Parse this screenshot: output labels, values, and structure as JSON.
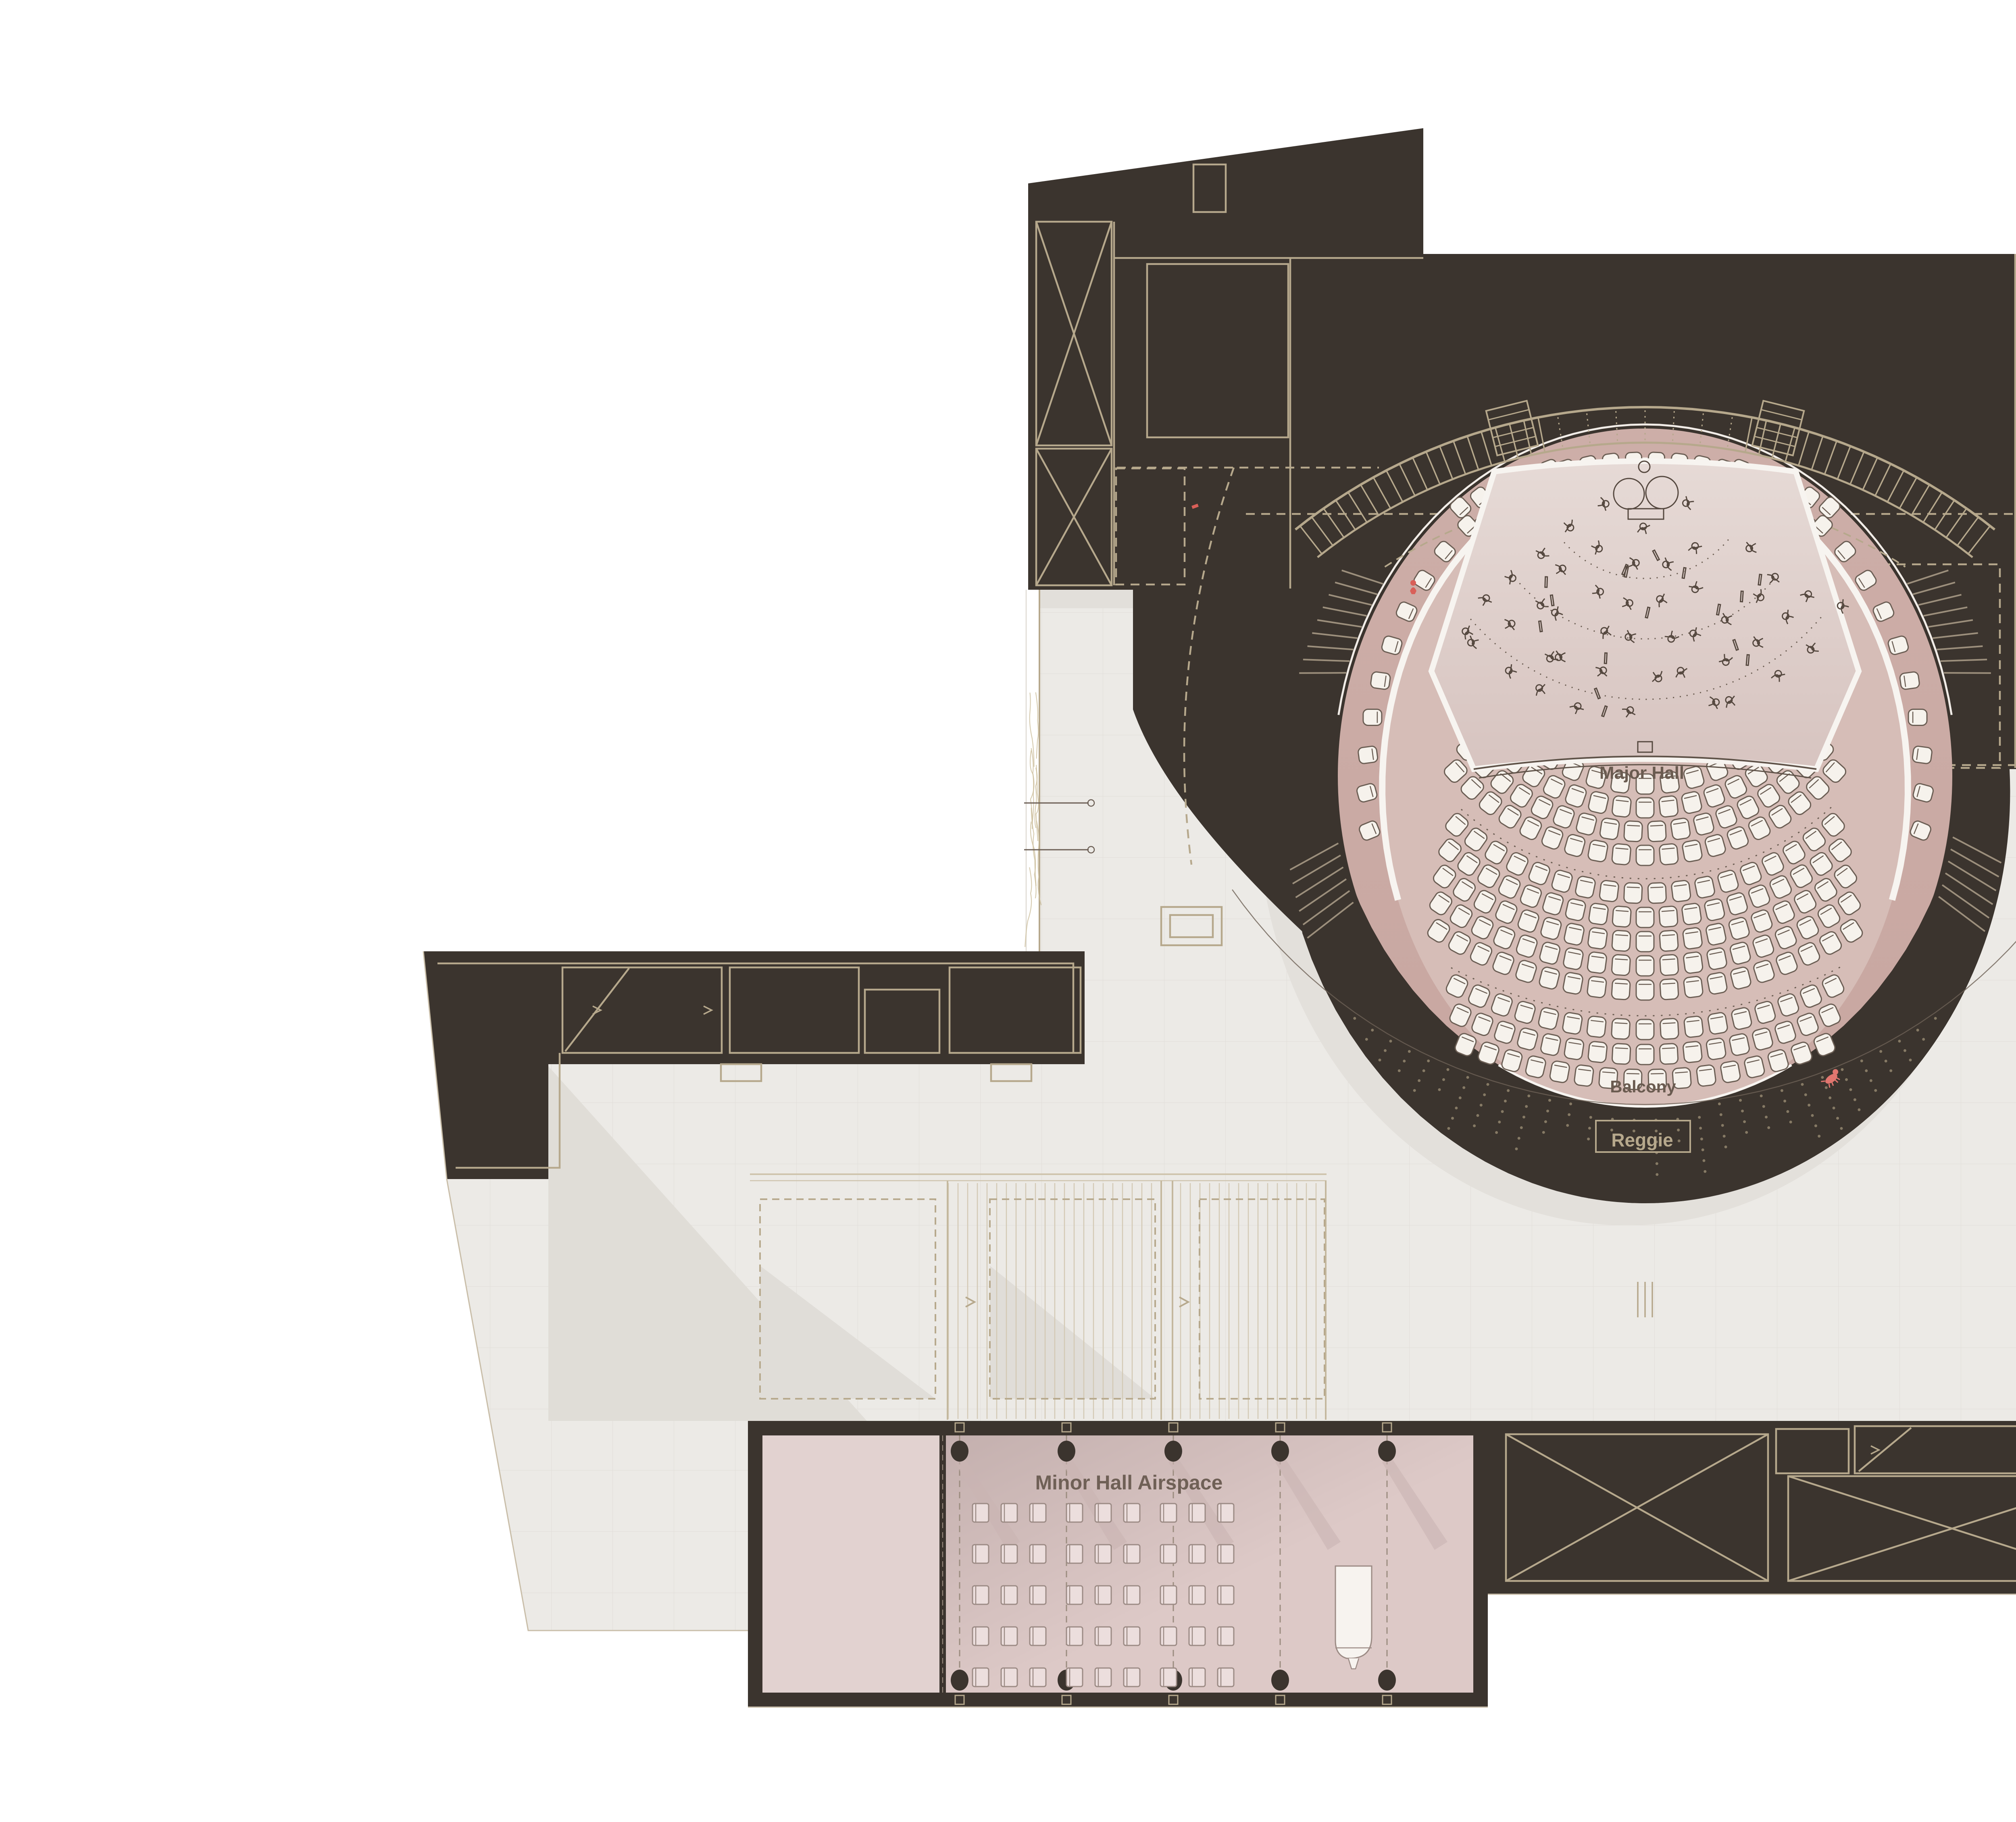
{
  "plan": {
    "type": "architectural floor plan",
    "halls": [
      "Major Hall",
      "Minor Hall"
    ]
  },
  "labels": {
    "major_hall": "Major Hall",
    "balcony": "Balcony",
    "reggie": "Reggie",
    "minor_hall_airspace": "Minor Hall Airspace"
  },
  "colors": {
    "background": "#ffffff",
    "dark_mass": "#3b342e",
    "dark_mass_edge": "#2f2a24",
    "line_tan": "#b6a88c",
    "line_tan_soft": "#cfc4ad",
    "floor": "#eceae6",
    "floor_line": "#e1ded9",
    "shadow": "#dfdcd6",
    "hall_band_pink": "#cdaea8",
    "hall_inner_pink": "#d6bdb7",
    "stage_light_top": "#e6dad6",
    "stage_light_bottom": "#d7c4c0",
    "minor_pink": "#ddc9c7",
    "minor_vestibule": "#e2d2d0",
    "seat_fill": "#f6f2ec",
    "seat_stroke": "#6b5e54",
    "ink": "#55483f",
    "label_ink": "#6a5b50",
    "minor_label_ink": "#6f6056",
    "white_band": "#f7f4f0",
    "vine": "#cdbf9e",
    "red_accent": "#d95f58",
    "dog_pink": "#e2766f",
    "bowl_dot": "#94876f"
  },
  "seating": {
    "organ_gallery_rows": 2,
    "choir_files": 2,
    "stalls_front_rows": 4,
    "stalls_rear_rows": 5,
    "balcony_rows": 3,
    "minor_hall_seat_grid": {
      "cols": 9,
      "rows": 5
    }
  },
  "icons": [
    {
      "name": "timpani-icon"
    },
    {
      "name": "musician-icon"
    },
    {
      "name": "conductor-podium-icon"
    },
    {
      "name": "grand-piano-icon"
    },
    {
      "name": "dog-icon"
    },
    {
      "name": "red-figure-icon"
    },
    {
      "name": "red-marker-icon"
    },
    {
      "name": "column-icon"
    },
    {
      "name": "stair-icon"
    },
    {
      "name": "shaft-x-icon"
    },
    {
      "name": "vine-wall-icon"
    },
    {
      "name": "door-swing-icon"
    }
  ]
}
